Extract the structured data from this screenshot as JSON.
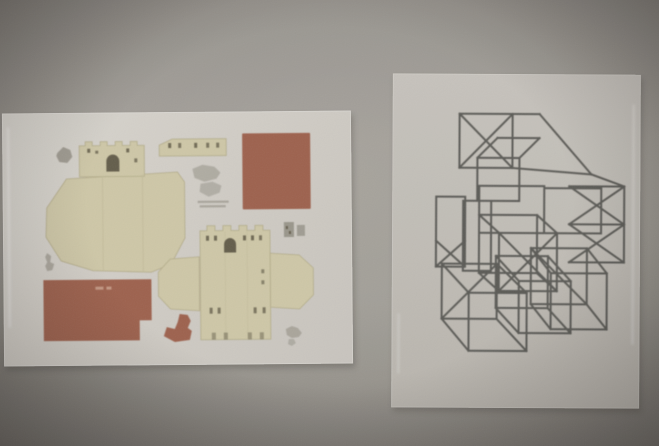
{
  "scene": {
    "type": "photograph",
    "description": "Dim, grainy photo of two sheets in clear plastic sleeves mounted on a gray wall",
    "wall_color": "#a29e98",
    "vignette_color": "#231b18"
  },
  "left_paper": {
    "name": "Castle papercraft cut-out template sheet in plastic sleeve",
    "sleeve_color": "#d6d2cc",
    "colors": {
      "cardstock_beige": "#d3ccab",
      "piece_outline": "#b7ae8c",
      "fold_line": "#c5bd9c",
      "roof_terracotta": "#a0614d",
      "roof_label": "#c89a86",
      "detail_gray": "#8f8b80",
      "dark_detail": "#57503f"
    },
    "pieces": [
      {
        "name": "castle-keep-with-battlements"
      },
      {
        "name": "large-unfolded-base"
      },
      {
        "name": "wall-strip-with-windows"
      },
      {
        "name": "square-roof-panel"
      },
      {
        "name": "second-castle-body-with-side-flaps"
      },
      {
        "name": "notched-rectangular-roof-panel"
      },
      {
        "name": "small-terracotta-hook-piece"
      },
      {
        "name": "small-gray-accessory-pieces"
      }
    ],
    "fine_print": "two tiny illegible gray text lines near sheet center"
  },
  "right_paper": {
    "name": "Geometric line drawing of overlapping wireframe cubes in plastic sleeve",
    "sleeve_color": "#c4c0ba",
    "ink_color": "#4c4c48",
    "subject": "transparent cubes in oblique projection, several faces crossed by diagonals"
  }
}
